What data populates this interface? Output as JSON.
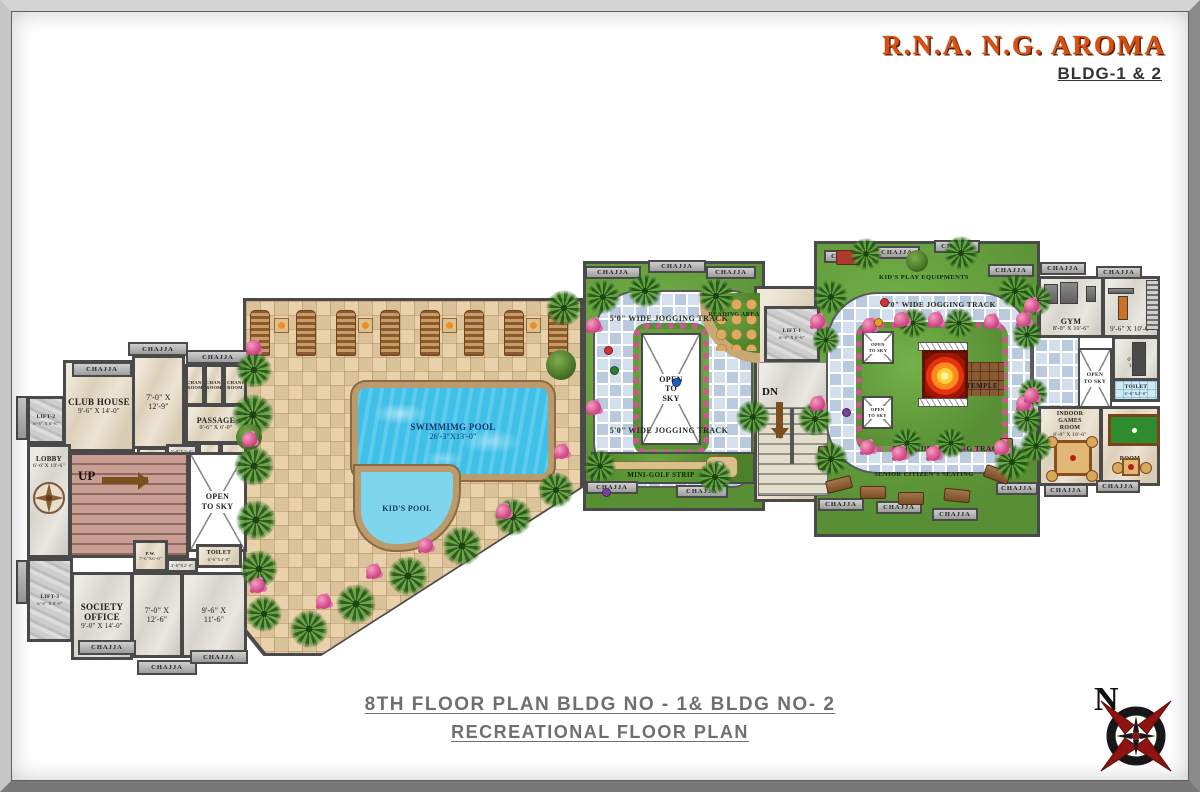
{
  "header": {
    "title": "R.N.A. N.G. AROMA",
    "subtitle": "BLDG-1 & 2"
  },
  "footer": {
    "line1": "8TH FLOOR PLAN  BLDG NO - 1& BLDG NO- 2",
    "line2": "RECREATIONAL FLOOR PLAN"
  },
  "compass": {
    "north": "N"
  },
  "common": {
    "chajja": "CHAJJA",
    "open_to_sky": "OPEN TO SKY",
    "up": "UP",
    "dn": "DN"
  },
  "left_building": {
    "lift2_name": "LIFT-2",
    "lift2_dim": "6'-6\" X 6'-6\"",
    "club_name": "CLUB HOUSE",
    "club_dim": "9'-6\" X 14'-0\"",
    "room_a_dim": "7'-0\" X 12'-9\"",
    "changing_room": "CHANGING ROOM",
    "passage_name": "PASSAGE",
    "passage_dim": "9'-6\" X 6'-0\"",
    "store_dim": "4'-6\" X 4'-0\"",
    "strip_dim": "5'-0\"X2'-0\"",
    "wc": "W.C.",
    "bath": "BATH",
    "lobby_name": "LOBBY",
    "lobby_dim": "6'-6\"X 19'-6\"",
    "pw_name": "P.W.",
    "pw_dim": "7'-6\"X6'-0\"",
    "toilet_name": "TOILET",
    "toilet_dim": "6'-6\"X4'-0\"",
    "pass2_dim": "4'-6\"X2'-0\"",
    "lift3_name": "LIFT-3",
    "lift3_dim": "6'-6\" X 8'-0\"",
    "office_name": "SOCIETY OFFICE",
    "office_dim": "9'-0\" X 14'-0\"",
    "room_b_dim": "7'-0\" X 12'-6\"",
    "room_c_dim": "9'-6\" X 11'-6\""
  },
  "pool_area": {
    "pool_name": "SWIMMIMG POOL",
    "pool_dim": "26'-3\"X13'-0\"",
    "kids_pool": "KID'S POOL"
  },
  "middle_building": {
    "jogging_track": "5'0\" WIDE JOGGING TRACK",
    "reading_area": "READING AREA",
    "mini_golf": "MINI-GOLF STRIP"
  },
  "connector": {
    "lift1_name": "LIFT-1",
    "lift1_dim": "6'-6\" X 6'-6\""
  },
  "right_building": {
    "kids_play": "KID'S PLAY EQUIPMENTS",
    "jogging_track": "5'0\" WIDE JOGGING TRACK",
    "temple": "TEMPLE",
    "senior_seating": "SENIOR CITIZEN'S SEATING"
  },
  "far_right_building": {
    "gym_name": "GYM",
    "gym_dim": "8'-0\" X 10'-6\"",
    "room_a_dim": "9'-6\" X 10'-0\"",
    "room_b_dim": "6'-6\" X 10'-0\"",
    "toilet_name": "TOILET",
    "toilet_dim": "6'-6\"X4'-0\"",
    "games_name": "INDOOR GAMES ROOM",
    "games_dim": "8'-0\" X 10'-6\"",
    "room_c_name": "ROOM",
    "room_c_dim": "9'-6\" X 10'-0\""
  },
  "colors": {
    "accent": "#d94f10",
    "wall": "#4a4a4a",
    "deck": "#e6cda2",
    "pool": "#3fc0e8",
    "lawn": "#5f9c3c",
    "track": "#c6d4e6",
    "titlegray": "#6f6f6f"
  }
}
